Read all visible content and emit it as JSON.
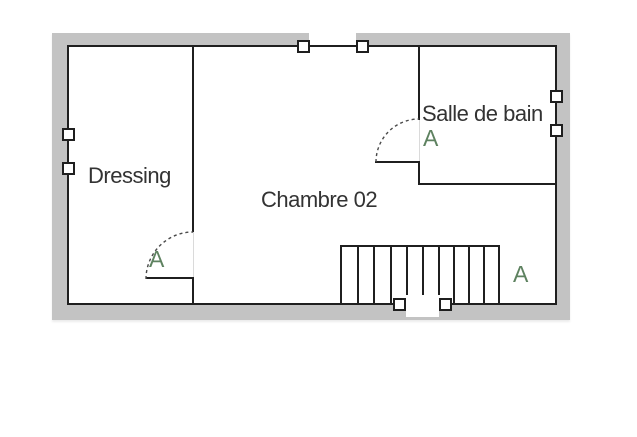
{
  "floor_plan": {
    "rooms": [
      {
        "id": "dressing",
        "label": "Dressing"
      },
      {
        "id": "chambre-02",
        "label": "Chambre 02"
      },
      {
        "id": "salle-de-bain",
        "label": "Salle de bain"
      }
    ],
    "door_marks": [
      {
        "at": "salle-de-bain-door",
        "label": "A"
      },
      {
        "at": "dressing-door",
        "label": "A"
      },
      {
        "at": "stairs-area",
        "label": "A"
      }
    ],
    "staircase": {
      "treads": 10
    },
    "windows": [
      {
        "wall": "top"
      },
      {
        "wall": "left"
      },
      {
        "wall": "right"
      },
      {
        "wall": "bottom"
      }
    ],
    "colors": {
      "outer_wall": "#c3c3c3",
      "wall_line": "#1f1f1f",
      "door_mark_green": "#5e8260",
      "room_label": "#333333",
      "floor": "#ffffff"
    }
  }
}
